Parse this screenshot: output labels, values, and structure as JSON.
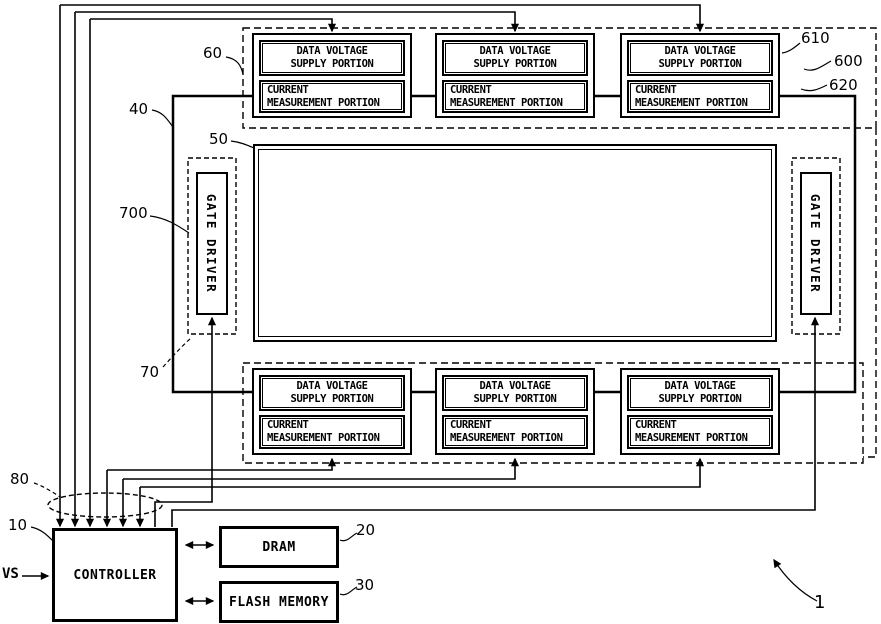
{
  "blocks": {
    "data_voltage_supply": {
      "line1": "DATA VOLTAGE",
      "line2": "SUPPLY PORTION"
    },
    "current_measurement": {
      "line1": "CURRENT",
      "line2": "MEASUREMENT PORTION"
    },
    "gate_driver": "GATE DRIVER",
    "controller": "CONTROLLER",
    "dram": "DRAM",
    "flash_memory": "FLASH MEMORY"
  },
  "signals": {
    "vs": "VS"
  },
  "refs": {
    "n1": "1",
    "n10": "10",
    "n20": "20",
    "n30": "30",
    "n40": "40",
    "n50": "50",
    "n60": "60",
    "n70": "70",
    "n80": "80",
    "n600": "600",
    "n610": "610",
    "n620": "620",
    "n700": "700"
  }
}
